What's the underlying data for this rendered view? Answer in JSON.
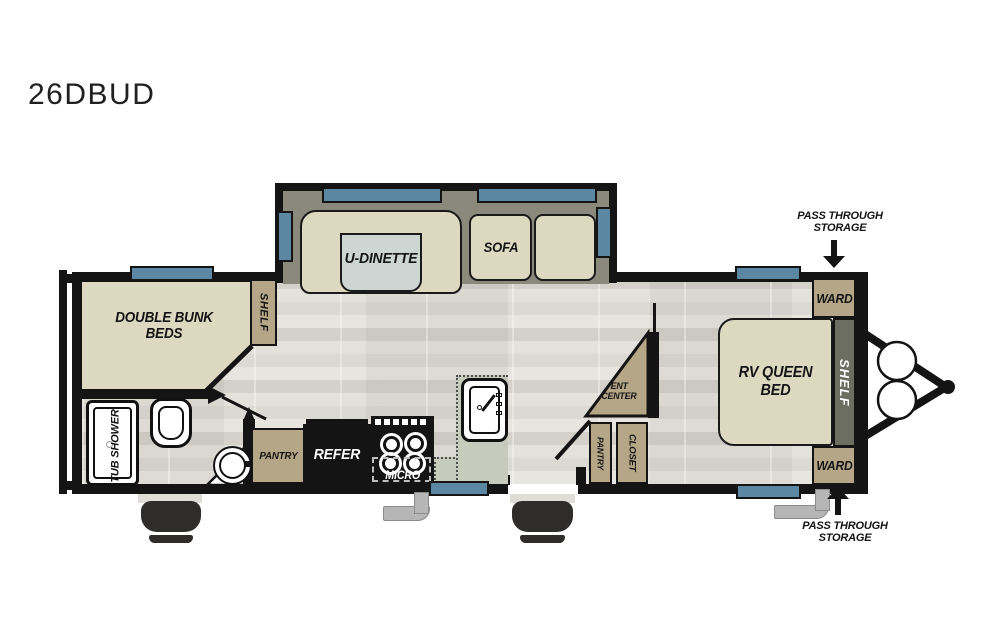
{
  "title": "26DBUD",
  "colors": {
    "wall": "#141414",
    "furniture_beige": "#ddd9c1",
    "cabinet_tan": "#b5a687",
    "slide_floor_olive": "#8a897b",
    "shelf_dark_olive": "#6d6e62",
    "window_blue": "#5c87a2",
    "counter_green": "#c6cbbc",
    "dinette_table_gray": "#cdd6d3",
    "floor_light": "#e8e6e1"
  },
  "rear_bedroom": {
    "bunks_label": "DOUBLE BUNK BEDS",
    "shelf_label": "SHELF"
  },
  "bathroom": {
    "tub_label": "TUB SHOWER"
  },
  "living_area": {
    "dinette_label": "U-DINETTE",
    "sofa_label": "SOFA"
  },
  "kitchen": {
    "pantry_label": "PANTRY",
    "refrigerator_label": "REFER",
    "microwave_label": "MICRO"
  },
  "mid_cabinets": {
    "ent_center_line1": "ENT",
    "ent_center_line2": "CENTER",
    "pantry_label": "PANTRY",
    "closet_label": "CLOSET"
  },
  "front_bedroom": {
    "bed_label": "RV QUEEN BED",
    "wardrobe_top_label": "WARD",
    "wardrobe_bottom_label": "WARD",
    "shelf_label": "SHELF"
  },
  "annotations": {
    "pass_through_top_line1": "PASS THROUGH",
    "pass_through_top_line2": "STORAGE",
    "pass_through_bottom_line1": "PASS THROUGH",
    "pass_through_bottom_line2": "STORAGE"
  }
}
